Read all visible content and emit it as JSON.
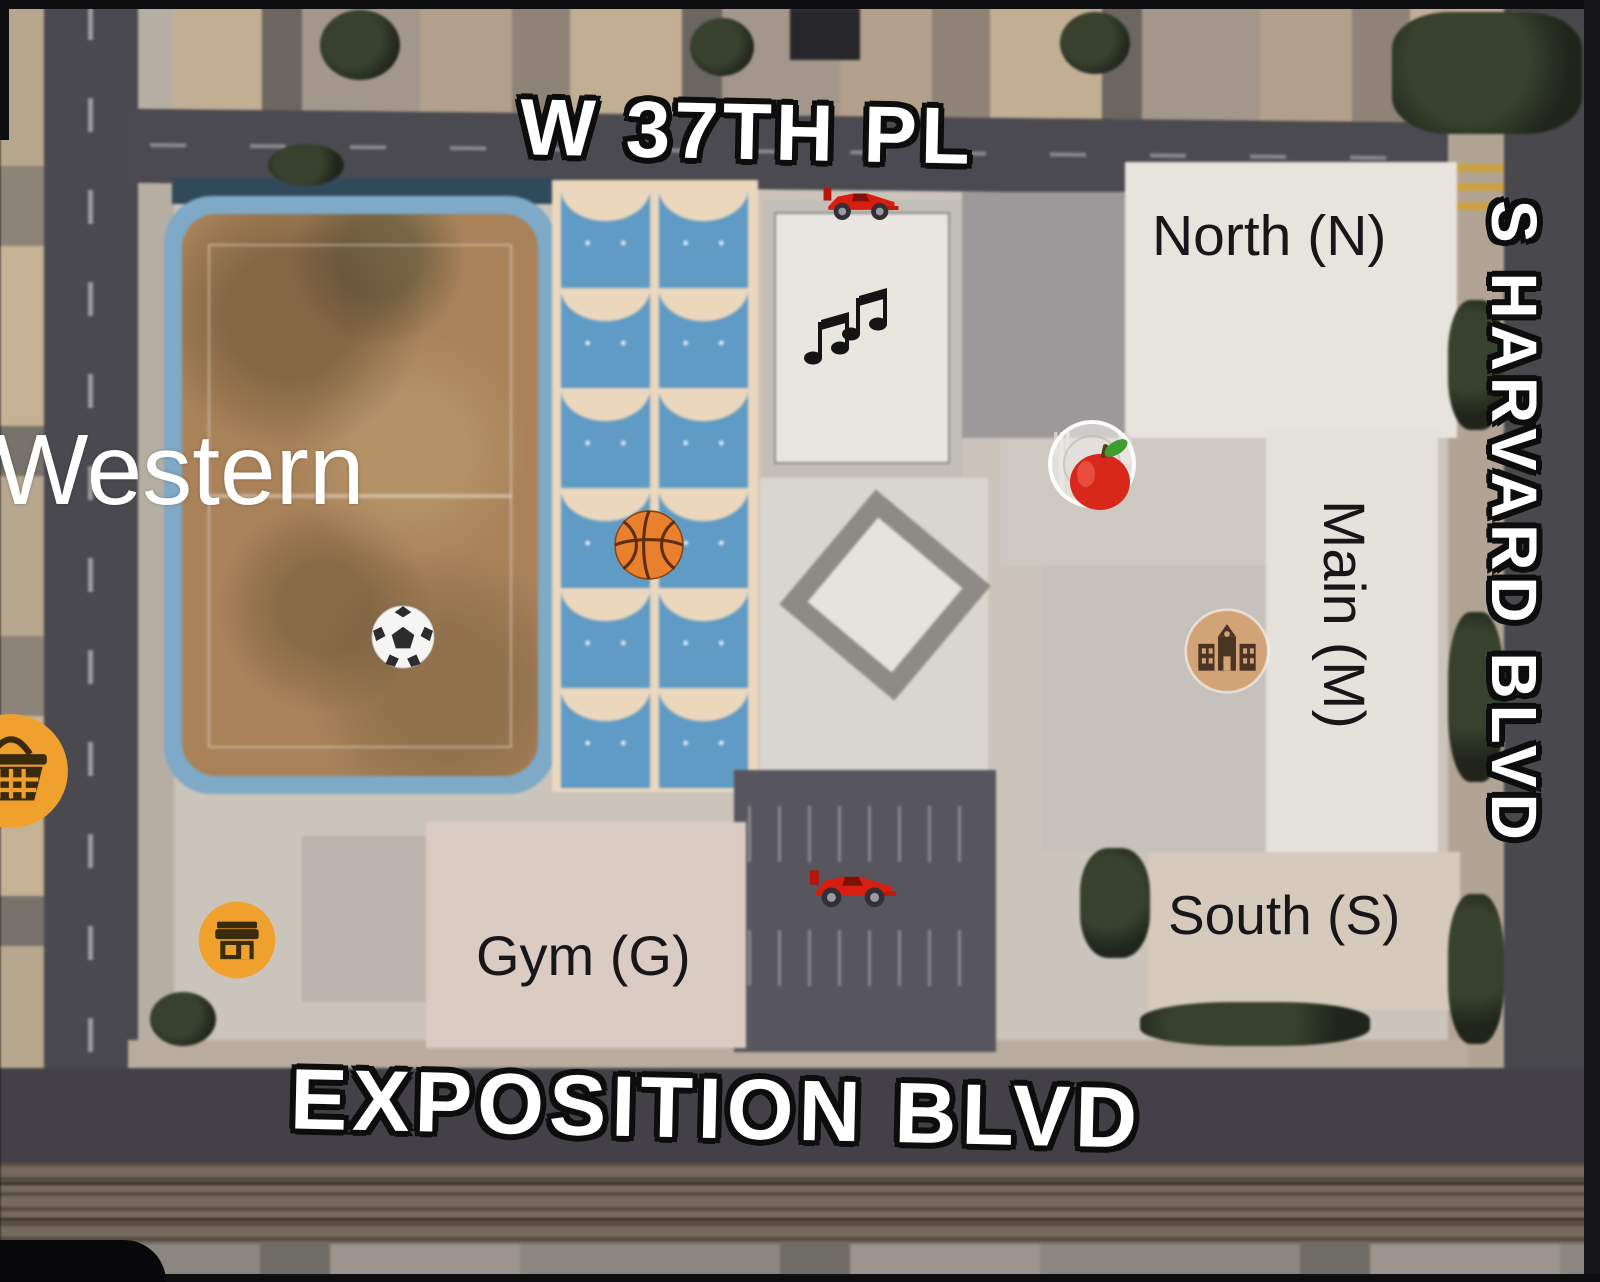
{
  "map": {
    "streets": {
      "w37th": "W 37TH PL",
      "harvard": "S HARVARD BLVD",
      "exposition": "EXPOSITION BLVD",
      "western": "Western"
    },
    "buildings": {
      "north": "North (N)",
      "main": "Main (M)",
      "south": "South (S)",
      "gym": "Gym (G)"
    },
    "markers": [
      {
        "name": "racing-car-icon",
        "location": "north driveway"
      },
      {
        "name": "musical-notes-icon",
        "location": "music building"
      },
      {
        "name": "plate-fork-knife-icon",
        "location": "cafeteria"
      },
      {
        "name": "apple-icon",
        "location": "cafeteria"
      },
      {
        "name": "basketball-icon",
        "location": "basketball courts"
      },
      {
        "name": "soccer-ball-icon",
        "location": "soccer field"
      },
      {
        "name": "school-poi-icon",
        "location": "main building"
      },
      {
        "name": "racing-car-icon",
        "location": "parking lot"
      },
      {
        "name": "convenience-store-poi-icon",
        "location": "corner building"
      },
      {
        "name": "grocery-basket-poi-icon",
        "location": "western avenue"
      }
    ],
    "colors": {
      "street_label": "#ffffff",
      "campus_label": "#17171a",
      "court_blue": "#5e9bc7",
      "court_cream": "#ecd7bb",
      "field_dirt": "#aa8257",
      "track_blue": "#7ca9c9",
      "poi_orange": "#f0a12d",
      "poi_school_tan": "#d2a377",
      "road_gray": "#4a494f",
      "frame_black": "#0e0e10"
    }
  }
}
